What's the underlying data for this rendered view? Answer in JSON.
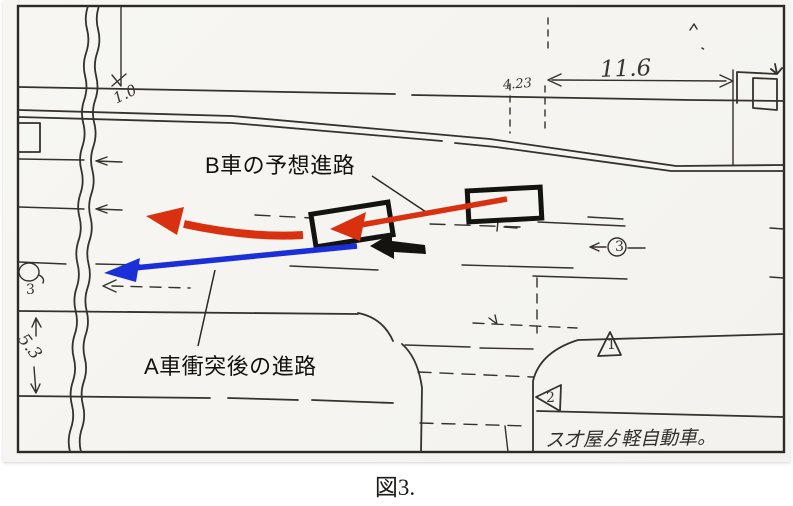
{
  "figure": {
    "caption": "図3."
  },
  "labels": {
    "b_predicted_path": "B車の予想進路",
    "a_after_collision_path": "A車衝突後の進路"
  },
  "dimensions": {
    "road_span": "11.6",
    "offset_small": "4.23",
    "top_left": "1.0",
    "left_vertical": "5.3"
  },
  "markers": {
    "circled_point_right": "3",
    "circled_point_left": "3",
    "triangle_upper": "1",
    "triangle_lower": "2"
  },
  "handwritten_note": "ス才屋ゟ軽自動車。",
  "colors": {
    "ink": "#35312b",
    "arrow_red": "#d93010",
    "arrow_blue": "#1b2fd8",
    "arrow_black": "#14130f"
  }
}
